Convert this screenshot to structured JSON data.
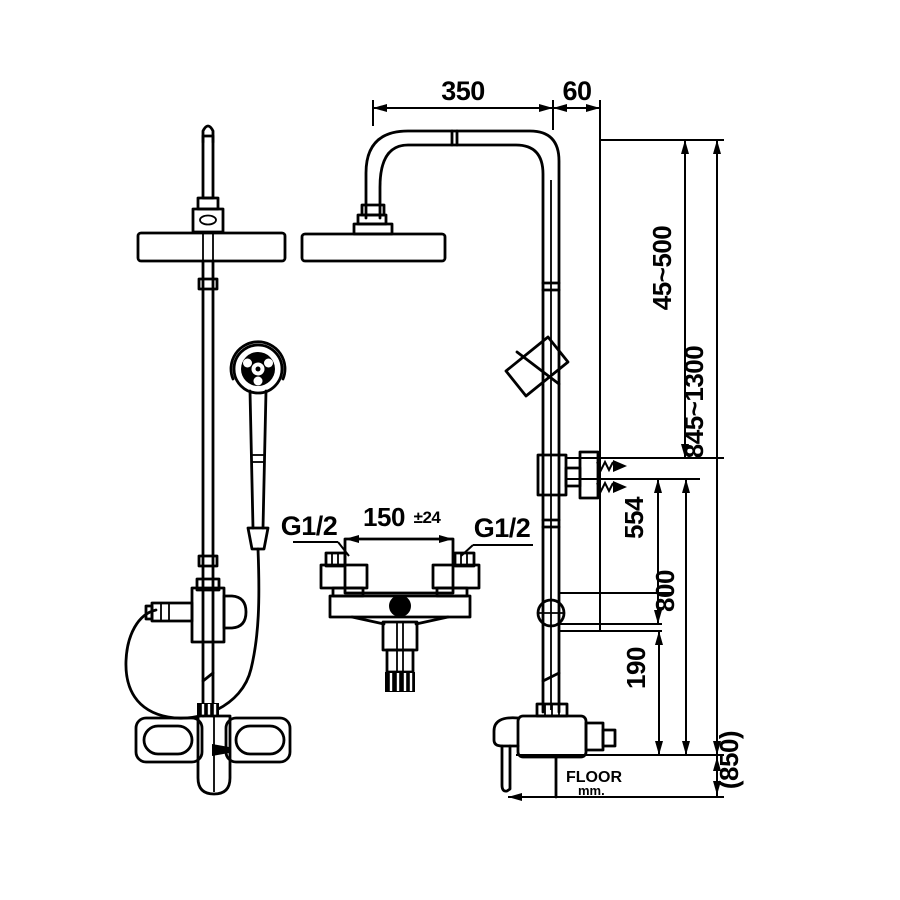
{
  "drawing": {
    "type": "shower-column-installation-diagram",
    "colors": {
      "line": "#000000",
      "background": "#ffffff"
    }
  },
  "dimensions": {
    "shower_arm_reach": "350",
    "wall_offset": "60",
    "head_height_adjust": "45~500",
    "overall_height": "845~1300",
    "bracket_drop": "554",
    "mixer_height": "800",
    "lower_section": "190",
    "floor_reference": "(850)",
    "inlet_center_distance": "150",
    "inlet_tolerance": "±24",
    "thread_left": "G1/2",
    "thread_right": "G1/2"
  },
  "floor_label": {
    "line1": "FLOOR",
    "line2": "mm."
  }
}
